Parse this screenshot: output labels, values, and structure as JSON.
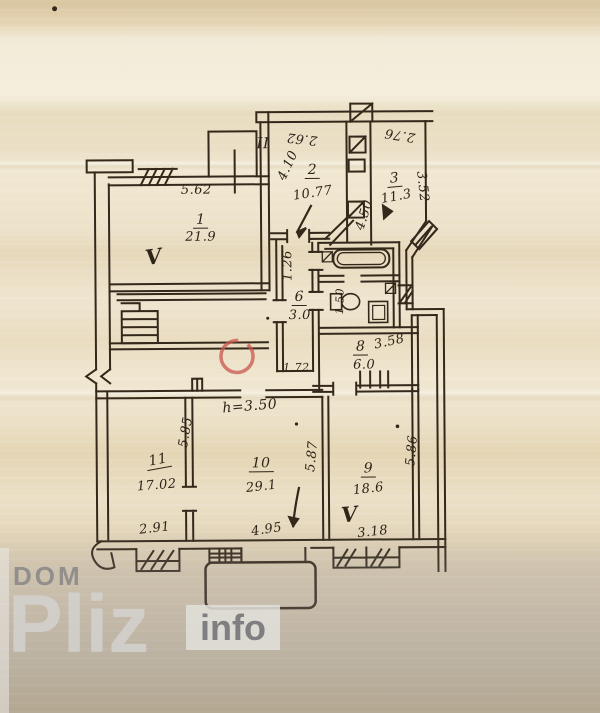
{
  "watermark": {
    "dom": "DOM",
    "pliz": "Pliz",
    "info": "info"
  },
  "plan": {
    "height_note": "h=3.50",
    "mark_ii": "II",
    "bath_dim": "1.50",
    "rooms": [
      {
        "id": "1",
        "area": "21.9",
        "top_dim": "5.62",
        "check": "V"
      },
      {
        "id": "2",
        "area": "10.77",
        "top_dim": "2.62",
        "side_dim": "4.10"
      },
      {
        "id": "3",
        "area": "11.3",
        "top_dim": "2.76",
        "side_dim": "3.52",
        "left_dim": "4.50"
      },
      {
        "id": "6",
        "area": "3.0",
        "side_dim": "1.26",
        "bottom_dim": "1.72"
      },
      {
        "id": "8",
        "area": "6.0",
        "top_dim": "3.58"
      },
      {
        "id": "9",
        "area": "18.6",
        "bottom_dim": "3.18",
        "side_dim": "5.86",
        "check": "V"
      },
      {
        "id": "10",
        "area": "29.1",
        "bottom_dim": "4.95",
        "side_dim": "5.87"
      },
      {
        "id": "11",
        "area": "17.02",
        "bottom_dim": "2.91",
        "side_dim": "5.85"
      }
    ]
  },
  "colors": {
    "ink": "#33281a",
    "red_annotation": "#c9564e",
    "paper": "#ece1c8"
  }
}
